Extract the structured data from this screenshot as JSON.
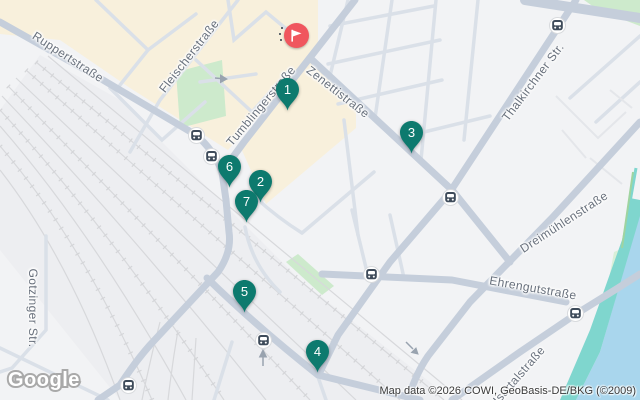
{
  "map": {
    "attribution": "Map data ©2026 COWI, GeoBasis-DE/BKG (©2009)",
    "logo_text": "Google",
    "colors": {
      "pin": "#0d7a6e",
      "pin_text": "#ffffff",
      "flag_bg": "#f0565e",
      "flag_glyph": "#ffffff",
      "land": "#f2f3f5",
      "district_beige": "#f8f0dc",
      "park_green": "#cdeacc",
      "road_major": "#c5cedb",
      "road_minor": "#dae0e8",
      "rail": "#d7d8db",
      "river_teal": "#7fd6ce",
      "water_blue": "#a9d6ed",
      "label_text": "#68707c",
      "transit_dark": "#3e4b5a"
    },
    "markers": [
      {
        "label": "1",
        "x": 287,
        "y": 89
      },
      {
        "label": "3",
        "x": 411,
        "y": 132
      },
      {
        "label": "6",
        "x": 229,
        "y": 166
      },
      {
        "label": "2",
        "x": 260,
        "y": 181
      },
      {
        "label": "7",
        "x": 246,
        "y": 201
      },
      {
        "label": "5",
        "x": 244,
        "y": 291
      },
      {
        "label": "4",
        "x": 317,
        "y": 351
      }
    ],
    "flag_marker": {
      "x": 296,
      "y": 35
    },
    "transit_stops": [
      {
        "x": 196,
        "y": 135
      },
      {
        "x": 211,
        "y": 156
      },
      {
        "x": 557,
        "y": 25
      },
      {
        "x": 450,
        "y": 197
      },
      {
        "x": 371,
        "y": 274
      },
      {
        "x": 575,
        "y": 313
      },
      {
        "x": 263,
        "y": 340
      },
      {
        "x": 128,
        "y": 385
      }
    ],
    "street_labels": [
      {
        "text": "Ruppertstraße",
        "x": 68,
        "y": 57,
        "rotate": 33
      },
      {
        "text": "Fleischerstraße",
        "x": 189,
        "y": 56,
        "rotate": -52
      },
      {
        "text": "Tumblingerstraße",
        "x": 261,
        "y": 106,
        "rotate": -50
      },
      {
        "text": "Zenettistraße",
        "x": 338,
        "y": 92,
        "rotate": 38
      },
      {
        "text": "Thalkirchner Str.",
        "x": 533,
        "y": 82,
        "rotate": -53
      },
      {
        "text": "Dreimühlenstraße",
        "x": 564,
        "y": 222,
        "rotate": -33
      },
      {
        "text": "Ehrengutstraße",
        "x": 533,
        "y": 288,
        "rotate": 10
      },
      {
        "text": "Isartalstraße",
        "x": 519,
        "y": 375,
        "rotate": -49
      },
      {
        "text": "Gotzinger Str.",
        "x": 33,
        "y": 308,
        "rotate": 90
      }
    ]
  }
}
